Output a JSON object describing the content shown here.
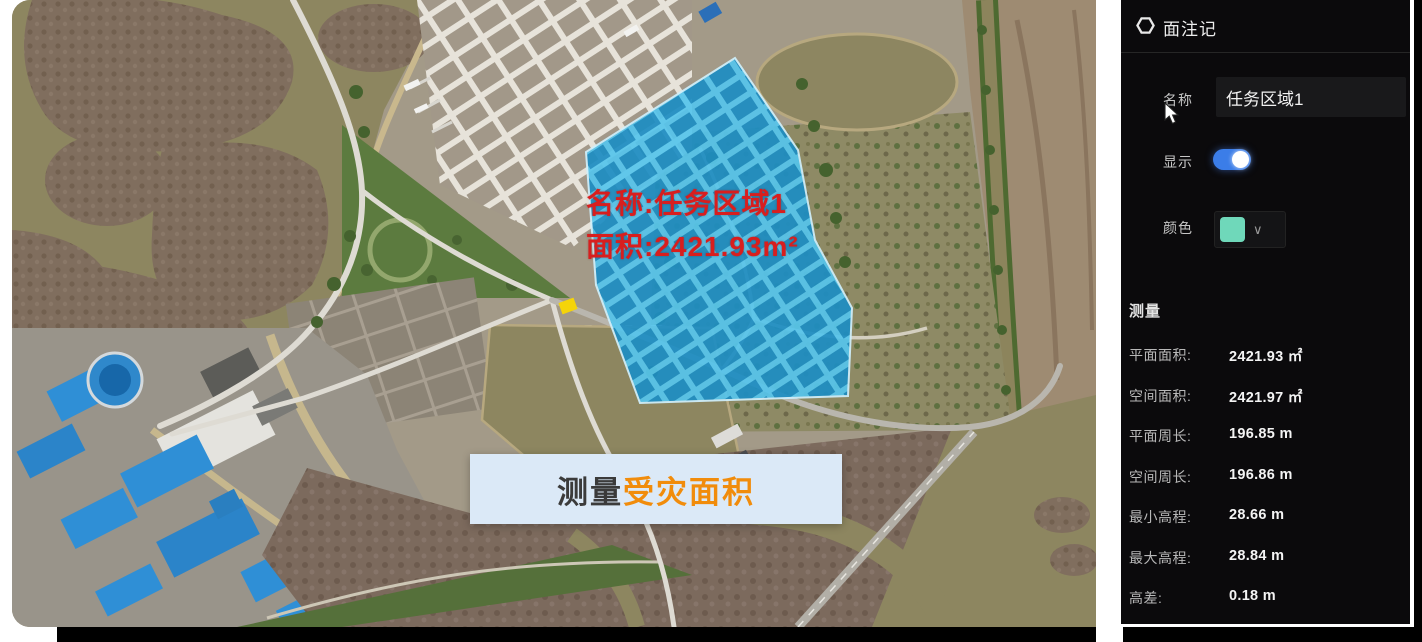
{
  "map": {
    "red_label": {
      "line1": "名称:任务区域1",
      "line2": "面积:2421.93m²",
      "color": "#d81e1e"
    },
    "caption": {
      "prefix": "测量",
      "highlight": "受灾面积",
      "bg": "#dbe9f7",
      "prefix_color": "#3b3b3b",
      "highlight_color": "#f18c0b"
    },
    "polygon_fill": "#3fb0e0"
  },
  "sidebar": {
    "title": "面注记",
    "icon": "hexagon-polygon-icon",
    "fields": {
      "name": {
        "label": "名称",
        "value": "任务区域1"
      },
      "display": {
        "label": "显示",
        "state": "on",
        "toggle_color": "#3b7de8"
      },
      "color": {
        "label": "颜色",
        "swatch": "#6fd8ba",
        "icon": "chevron-down-icon"
      }
    },
    "measure": {
      "title": "测量",
      "rows": [
        {
          "label": "平面面积:",
          "value": "2421.93 ㎡"
        },
        {
          "label": "空间面积:",
          "value": "2421.97 ㎡"
        },
        {
          "label": "平面周长:",
          "value": "196.85 m"
        },
        {
          "label": "空间周长:",
          "value": "196.86 m"
        },
        {
          "label": "最小高程:",
          "value": "28.66 m"
        },
        {
          "label": "最大高程:",
          "value": "28.84 m"
        },
        {
          "label": "高差:",
          "value": "0.18 m"
        }
      ]
    }
  }
}
